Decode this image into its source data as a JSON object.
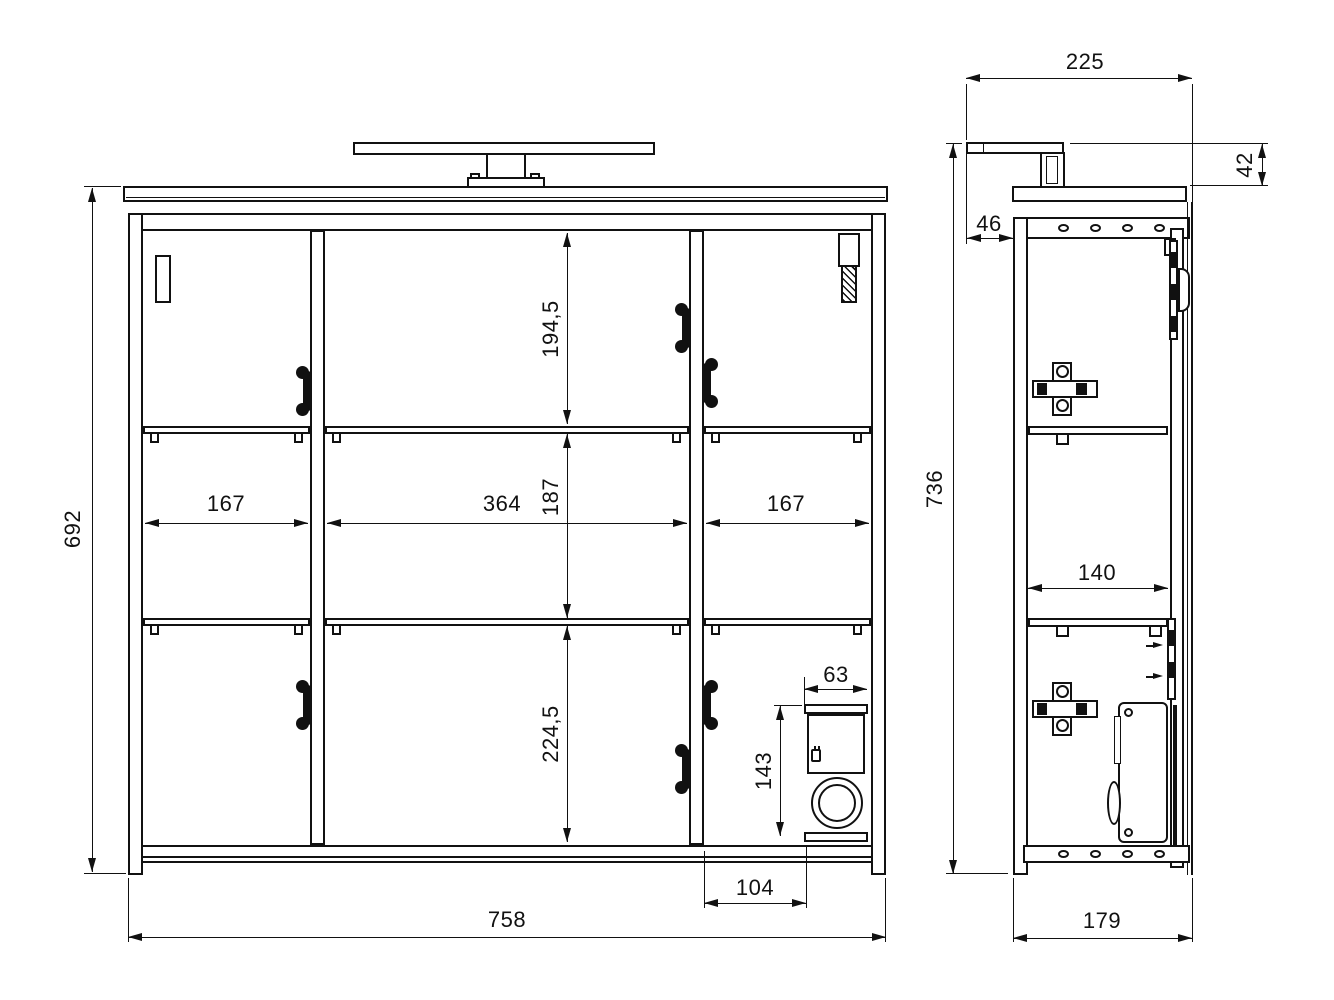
{
  "drawing": {
    "type": "technical-dimension-drawing",
    "line_color": "#111111",
    "background_color": "#ffffff",
    "views": {
      "front": {
        "dims": {
          "total_height": "692",
          "total_width": "758",
          "upper_compartment_height": "194,5",
          "middle_compartment_height": "187",
          "lower_compartment_height": "224,5",
          "left_compartment_width": "167",
          "center_compartment_width": "364",
          "right_compartment_width": "167",
          "socket_niche_width": "63",
          "socket_niche_height": "143",
          "socket_niche_offset": "104"
        }
      },
      "side": {
        "dims": {
          "total_depth": "225",
          "lamp_height_above_top": "42",
          "lamp_rear_offset": "46",
          "total_height": "736",
          "interior_shelf_depth": "140",
          "body_depth": "179"
        }
      }
    }
  }
}
